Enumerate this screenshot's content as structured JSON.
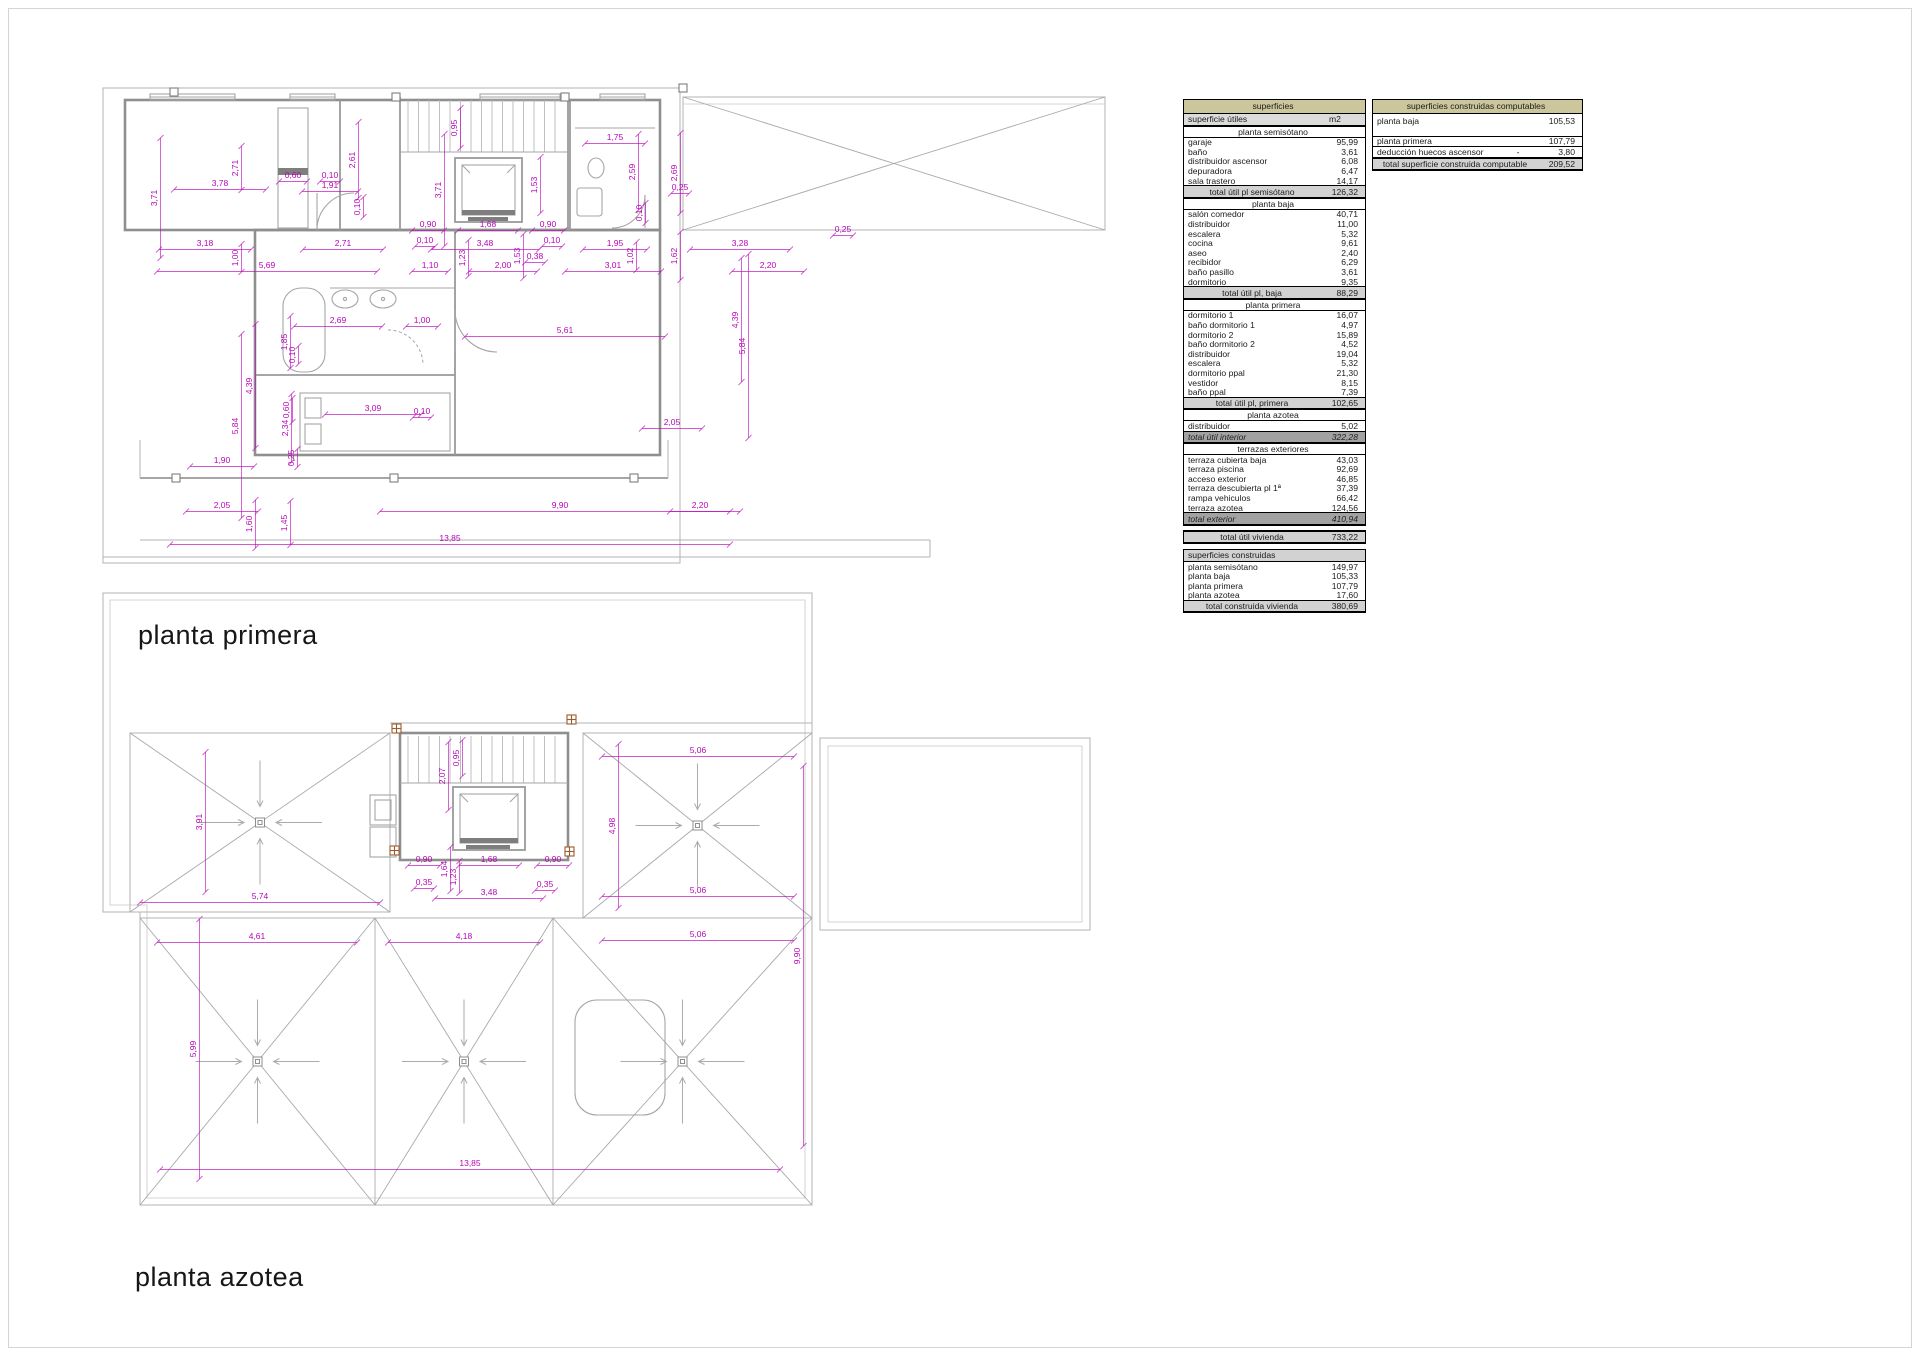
{
  "page": {
    "background": "#ffffff"
  },
  "colors": {
    "dimension_magenta": "#b606b6",
    "wall_gray": "#8f8f8f",
    "thin_gray": "#b3b3b3",
    "table_header_tan": "#cbc69b",
    "table_subheader_gray": "#dcdcdc",
    "table_total_gray": "#d2d2d2",
    "table_dark_total_gray": "#a2a2a2",
    "pillar_brown": "#9a5b2d"
  },
  "plans": {
    "primera": {
      "title": "planta primera",
      "dims": [
        {
          "t": "2,71",
          "x": 238,
          "y": 168,
          "r": 1
        },
        {
          "t": "3,78",
          "x": 220,
          "y": 186,
          "L": 46
        },
        {
          "t": "3,71",
          "x": 157,
          "y": 198,
          "r": 1,
          "L": 60
        },
        {
          "t": "3,18",
          "x": 205,
          "y": 246,
          "L": 46
        },
        {
          "t": "1,00",
          "x": 238,
          "y": 258,
          "r": 1,
          "L": 14
        },
        {
          "t": "5,69",
          "x": 267,
          "y": 268,
          "L": 110
        },
        {
          "t": "0,60",
          "x": 293,
          "y": 178,
          "L": 14
        },
        {
          "t": "0,10",
          "x": 330,
          "y": 178,
          "L": 10
        },
        {
          "t": "1,91",
          "x": 330,
          "y": 188,
          "L": 28
        },
        {
          "t": "2,61",
          "x": 355,
          "y": 160,
          "r": 1,
          "L": 38
        },
        {
          "t": "0,10",
          "x": 360,
          "y": 207,
          "r": 1,
          "L": 10
        },
        {
          "t": "2,71",
          "x": 343,
          "y": 246,
          "L": 40
        },
        {
          "t": "0,95",
          "x": 457,
          "y": 128,
          "r": 1,
          "L": 20
        },
        {
          "t": "3,71",
          "x": 441,
          "y": 190,
          "r": 1,
          "L": 56
        },
        {
          "t": "1,53",
          "x": 537,
          "y": 185,
          "r": 1,
          "L": 28
        },
        {
          "t": "0,90",
          "x": 428,
          "y": 227,
          "L": 16
        },
        {
          "t": "1,68",
          "x": 488,
          "y": 227,
          "L": 30
        },
        {
          "t": "0,90",
          "x": 548,
          "y": 227,
          "L": 16
        },
        {
          "t": "0,10",
          "x": 425,
          "y": 243,
          "L": 10
        },
        {
          "t": "3,48",
          "x": 485,
          "y": 246,
          "L": 54
        },
        {
          "t": "0,10",
          "x": 552,
          "y": 243,
          "L": 10
        },
        {
          "t": "1,23",
          "x": 465,
          "y": 258,
          "r": 1,
          "L": 18
        },
        {
          "t": "1,53",
          "x": 520,
          "y": 256,
          "r": 1,
          "L": 22
        },
        {
          "t": "0,38",
          "x": 535,
          "y": 259,
          "L": 10
        },
        {
          "t": "1,10",
          "x": 430,
          "y": 268,
          "L": 18
        },
        {
          "t": "2,00",
          "x": 503,
          "y": 268,
          "L": 34
        },
        {
          "t": "1,75",
          "x": 615,
          "y": 140,
          "L": 30
        },
        {
          "t": "2,59",
          "x": 635,
          "y": 172,
          "r": 1,
          "L": 38
        },
        {
          "t": "2,69",
          "x": 677,
          "y": 173,
          "r": 1,
          "L": 40
        },
        {
          "t": "0,10",
          "x": 642,
          "y": 213,
          "r": 1,
          "L": 10
        },
        {
          "t": "1,95",
          "x": 615,
          "y": 246,
          "L": 32
        },
        {
          "t": "1,02",
          "x": 633,
          "y": 256,
          "r": 1,
          "L": 14
        },
        {
          "t": "1,62",
          "x": 677,
          "y": 256,
          "r": 1,
          "L": 24
        },
        {
          "t": "3,01",
          "x": 613,
          "y": 268,
          "L": 48
        },
        {
          "t": "0,25",
          "x": 843,
          "y": 232,
          "L": 10
        },
        {
          "t": "3,28",
          "x": 740,
          "y": 246,
          "L": 50
        },
        {
          "t": "2,20",
          "x": 768,
          "y": 268,
          "L": 36
        },
        {
          "t": "2,69",
          "x": 338,
          "y": 323,
          "L": 44
        },
        {
          "t": "1,00",
          "x": 422,
          "y": 323,
          "L": 16
        },
        {
          "t": "1,85",
          "x": 287,
          "y": 342,
          "r": 1,
          "L": 26
        },
        {
          "t": "0,10",
          "x": 295,
          "y": 355,
          "r": 1,
          "L": 9
        },
        {
          "t": "0,60",
          "x": 289,
          "y": 410,
          "r": 1,
          "L": 12
        },
        {
          "t": "2,34",
          "x": 288,
          "y": 428,
          "r": 1,
          "L": 34
        },
        {
          "t": "0,25",
          "x": 294,
          "y": 458,
          "r": 1,
          "L": 9
        },
        {
          "t": "3,09",
          "x": 373,
          "y": 411,
          "L": 48
        },
        {
          "t": "0,10",
          "x": 422,
          "y": 414,
          "L": 9
        },
        {
          "t": "5,61",
          "x": 565,
          "y": 333,
          "L": 100
        },
        {
          "t": "4,39",
          "x": 252,
          "y": 386,
          "r": 1,
          "L": 62
        },
        {
          "t": "4,39",
          "x": 738,
          "y": 320,
          "r": 1,
          "L": 62
        },
        {
          "t": "5,84",
          "x": 238,
          "y": 426,
          "r": 1,
          "L": 92
        },
        {
          "t": "5,84",
          "x": 745,
          "y": 346,
          "r": 1,
          "L": 92
        },
        {
          "t": "1,90",
          "x": 222,
          "y": 463,
          "L": 32
        },
        {
          "t": "2,05",
          "x": 222,
          "y": 508,
          "L": 36
        },
        {
          "t": "1,60",
          "x": 252,
          "y": 524,
          "r": 1,
          "L": 24
        },
        {
          "t": "1,45",
          "x": 287,
          "y": 523,
          "r": 1,
          "L": 22
        },
        {
          "t": "9,90",
          "x": 560,
          "y": 508,
          "L": 180
        },
        {
          "t": "13,85",
          "x": 450,
          "y": 541,
          "L": 280
        },
        {
          "t": "2,05",
          "x": 672,
          "y": 425,
          "L": 30
        },
        {
          "t": "2,20",
          "x": 700,
          "y": 508,
          "L": 30
        },
        {
          "t": "0,25",
          "x": 680,
          "y": 190,
          "L": 9
        }
      ]
    },
    "azotea": {
      "title": "planta azotea",
      "dims": [
        {
          "t": "3,91",
          "x": 202,
          "y": 822,
          "r": 1,
          "L": 70
        },
        {
          "t": "5,74",
          "x": 260,
          "y": 899,
          "L": 120
        },
        {
          "t": "4,61",
          "x": 257,
          "y": 939,
          "L": 100
        },
        {
          "t": "4,18",
          "x": 464,
          "y": 939,
          "L": 76
        },
        {
          "t": "5,06",
          "x": 698,
          "y": 753,
          "L": 96
        },
        {
          "t": "4,98",
          "x": 615,
          "y": 826,
          "r": 1,
          "L": 82
        },
        {
          "t": "5,06",
          "x": 698,
          "y": 893,
          "L": 96
        },
        {
          "t": "5,06",
          "x": 698,
          "y": 937,
          "L": 96
        },
        {
          "t": "9,90",
          "x": 800,
          "y": 956,
          "r": 1,
          "L": 190
        },
        {
          "t": "5,99",
          "x": 196,
          "y": 1049,
          "r": 1,
          "L": 130
        },
        {
          "t": "13,85",
          "x": 470,
          "y": 1166,
          "L": 310
        },
        {
          "t": "0,95",
          "x": 459,
          "y": 758,
          "r": 1,
          "L": 18
        },
        {
          "t": "2,07",
          "x": 445,
          "y": 776,
          "r": 1,
          "L": 34
        },
        {
          "t": "0,90",
          "x": 424,
          "y": 862,
          "L": 16
        },
        {
          "t": "1,68",
          "x": 489,
          "y": 862,
          "L": 30
        },
        {
          "t": "0,90",
          "x": 553,
          "y": 862,
          "L": 16
        },
        {
          "t": "1,64",
          "x": 447,
          "y": 869,
          "r": 1,
          "L": 22
        },
        {
          "t": "1,23",
          "x": 456,
          "y": 877,
          "r": 1,
          "L": 16
        },
        {
          "t": "0,35",
          "x": 424,
          "y": 885,
          "L": 10
        },
        {
          "t": "0,35",
          "x": 545,
          "y": 887,
          "L": 10
        },
        {
          "t": "3,48",
          "x": 489,
          "y": 895,
          "L": 54
        }
      ]
    }
  },
  "tables": {
    "superficies": {
      "blocks": [
        {
          "rows": [
            {
              "k": "title",
              "l": "superficies"
            },
            {
              "k": "head",
              "l": "superficie útiles",
              "v": "m2"
            },
            {
              "k": "sect",
              "l": "planta semisótano"
            },
            {
              "l": "garaje",
              "v": "95,99"
            },
            {
              "l": "baño",
              "v": "3,61"
            },
            {
              "l": "distribuidor ascensor",
              "v": "6,08"
            },
            {
              "l": "depuradora",
              "v": "6,47"
            },
            {
              "l": "sala trastero",
              "v": "14,17"
            },
            {
              "k": "total",
              "l": "total útil pl semisótano",
              "v": "126,32"
            },
            {
              "k": "sect",
              "l": "planta baja"
            },
            {
              "l": "salón comedor",
              "v": "40,71"
            },
            {
              "l": "distribuidor",
              "v": "11,00"
            },
            {
              "l": "escalera",
              "v": "5,32"
            },
            {
              "l": "cocina",
              "v": "9,61"
            },
            {
              "l": "aseo",
              "v": "2,40"
            },
            {
              "l": "recibidor",
              "v": "6,29"
            },
            {
              "l": "baño pasillo",
              "v": "3,61"
            },
            {
              "l": "dormitorio",
              "v": "9,35"
            },
            {
              "k": "total",
              "l": "total útil pl, baja",
              "v": "88,29"
            },
            {
              "k": "sect",
              "l": "planta primera"
            },
            {
              "l": "dormitorio 1",
              "v": "16,07"
            },
            {
              "l": "baño dormitorio 1",
              "v": "4,97"
            },
            {
              "l": "dormitorio 2",
              "v": "15,89"
            },
            {
              "l": "baño dormitorio 2",
              "v": "4,52"
            },
            {
              "l": "distribuidor",
              "v": "19,04"
            },
            {
              "l": "escalera",
              "v": "5,32"
            },
            {
              "l": "dormitorio ppal",
              "v": "21,30"
            },
            {
              "l": "vestidor",
              "v": "8,15"
            },
            {
              "l": "baño ppal",
              "v": "7,39"
            },
            {
              "k": "total",
              "l": "total útil pl, primera",
              "v": "102,65"
            },
            {
              "k": "sect",
              "l": "planta azotea"
            },
            {
              "l": "distribuidor",
              "v": "5,02"
            },
            {
              "k": "dtotal",
              "l": "total útil interior",
              "v": "322,28"
            },
            {
              "k": "sect",
              "l": "terrazas exteriores"
            },
            {
              "l": "terraza cubierta baja",
              "v": "43,03"
            },
            {
              "l": "terraza piscina",
              "v": "92,69"
            },
            {
              "l": "acceso exterior",
              "v": "46,85"
            },
            {
              "l": "terraza descubierta pl 1ª",
              "v": "37,39"
            },
            {
              "l": "rampa vehiculos",
              "v": "66,42"
            },
            {
              "l": "terraza  azotea",
              "v": "124,56"
            },
            {
              "k": "dtotal",
              "l": "total exterior",
              "v": "410,94"
            }
          ]
        },
        {
          "gap": 4,
          "rows": [
            {
              "k": "total",
              "l": "total útil vivienda",
              "v": "733,22"
            }
          ]
        },
        {
          "gap": 5,
          "rows": [
            {
              "k": "chead",
              "l": "superficies construidas"
            },
            {
              "l": "planta semisótano",
              "v": "149,97"
            },
            {
              "l": "planta baja",
              "v": "105,33"
            },
            {
              "l": "planta primera",
              "v": "107,79"
            },
            {
              "l": "planta azotea",
              "v": "17,60"
            },
            {
              "k": "total",
              "l": "total construida vivienda",
              "v": "380,69"
            }
          ]
        }
      ]
    },
    "computables": {
      "blocks": [
        {
          "rows": [
            {
              "k": "title",
              "l": "superficies construidas computables"
            },
            {
              "c": "tall",
              "l": "planta baja",
              "v": "105,53"
            },
            {
              "c": "bb",
              "l": "planta primera",
              "v": "107,79"
            },
            {
              "c": "bb",
              "l": "deducción huecos ascensor",
              "m": "-",
              "v": "3,80"
            },
            {
              "k": "total",
              "l": "total superficie construida computable",
              "v": "209,52"
            }
          ]
        }
      ]
    }
  }
}
